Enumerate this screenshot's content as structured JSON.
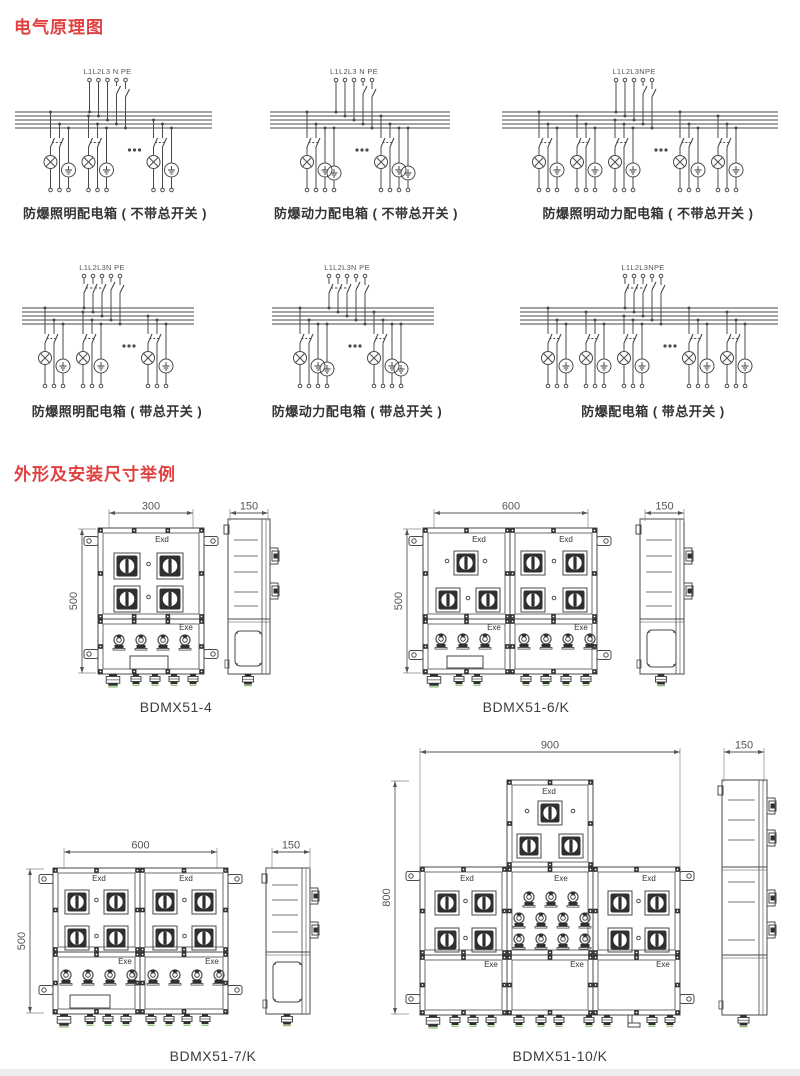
{
  "page": {
    "background": "#ffffff",
    "accent_red": "#e04040",
    "line_color": "#4a4a4a",
    "footer_strip_color": "#ededed"
  },
  "sections": {
    "schematics": {
      "title": "电气原理图"
    },
    "dimensions": {
      "title": "外形及安装尺寸举例"
    }
  },
  "circuits": [
    {
      "caption": "防爆照明配电箱 ( 不带总开关 )",
      "terminals": "L1L2L3 N PE"
    },
    {
      "caption": "防爆动力配电箱 ( 不带总开关 )",
      "terminals": "L1L2L3 N PE"
    },
    {
      "caption": "防爆照明动力配电箱 ( 不带总开关 )",
      "terminals": "L1L2L3NPE"
    },
    {
      "caption": "防爆照明配电箱 ( 带总开关 )",
      "terminals": "L1L2L3N PE"
    },
    {
      "caption": "防爆动力配电箱 ( 带总开关 )",
      "terminals": "L1L2L3N PE"
    },
    {
      "caption": "防爆配电箱 ( 带总开关 )",
      "terminals": "L1L2L3NPE"
    }
  ],
  "cabinets": [
    {
      "model": "BDMX51-4",
      "width_dim": "300",
      "height_dim": "500",
      "depth_dim": "150",
      "labels": {
        "exd": "Exd",
        "exe": "Exe"
      }
    },
    {
      "model": "BDMX51-6/K",
      "width_dim": "600",
      "height_dim": "500",
      "depth_dim": "150",
      "labels": {
        "exd": "Exd",
        "exe": "Exe"
      }
    },
    {
      "model": "BDMX51-7/K",
      "width_dim": "600",
      "height_dim": "500",
      "depth_dim": "150",
      "labels": {
        "exd": "Exd",
        "exe": "Exe"
      }
    },
    {
      "model": "BDMX51-10/K",
      "width_dim": "900",
      "height_dim": "800",
      "depth_dim": "150",
      "labels": {
        "exd": "Exd",
        "exe": "Exe"
      }
    }
  ]
}
